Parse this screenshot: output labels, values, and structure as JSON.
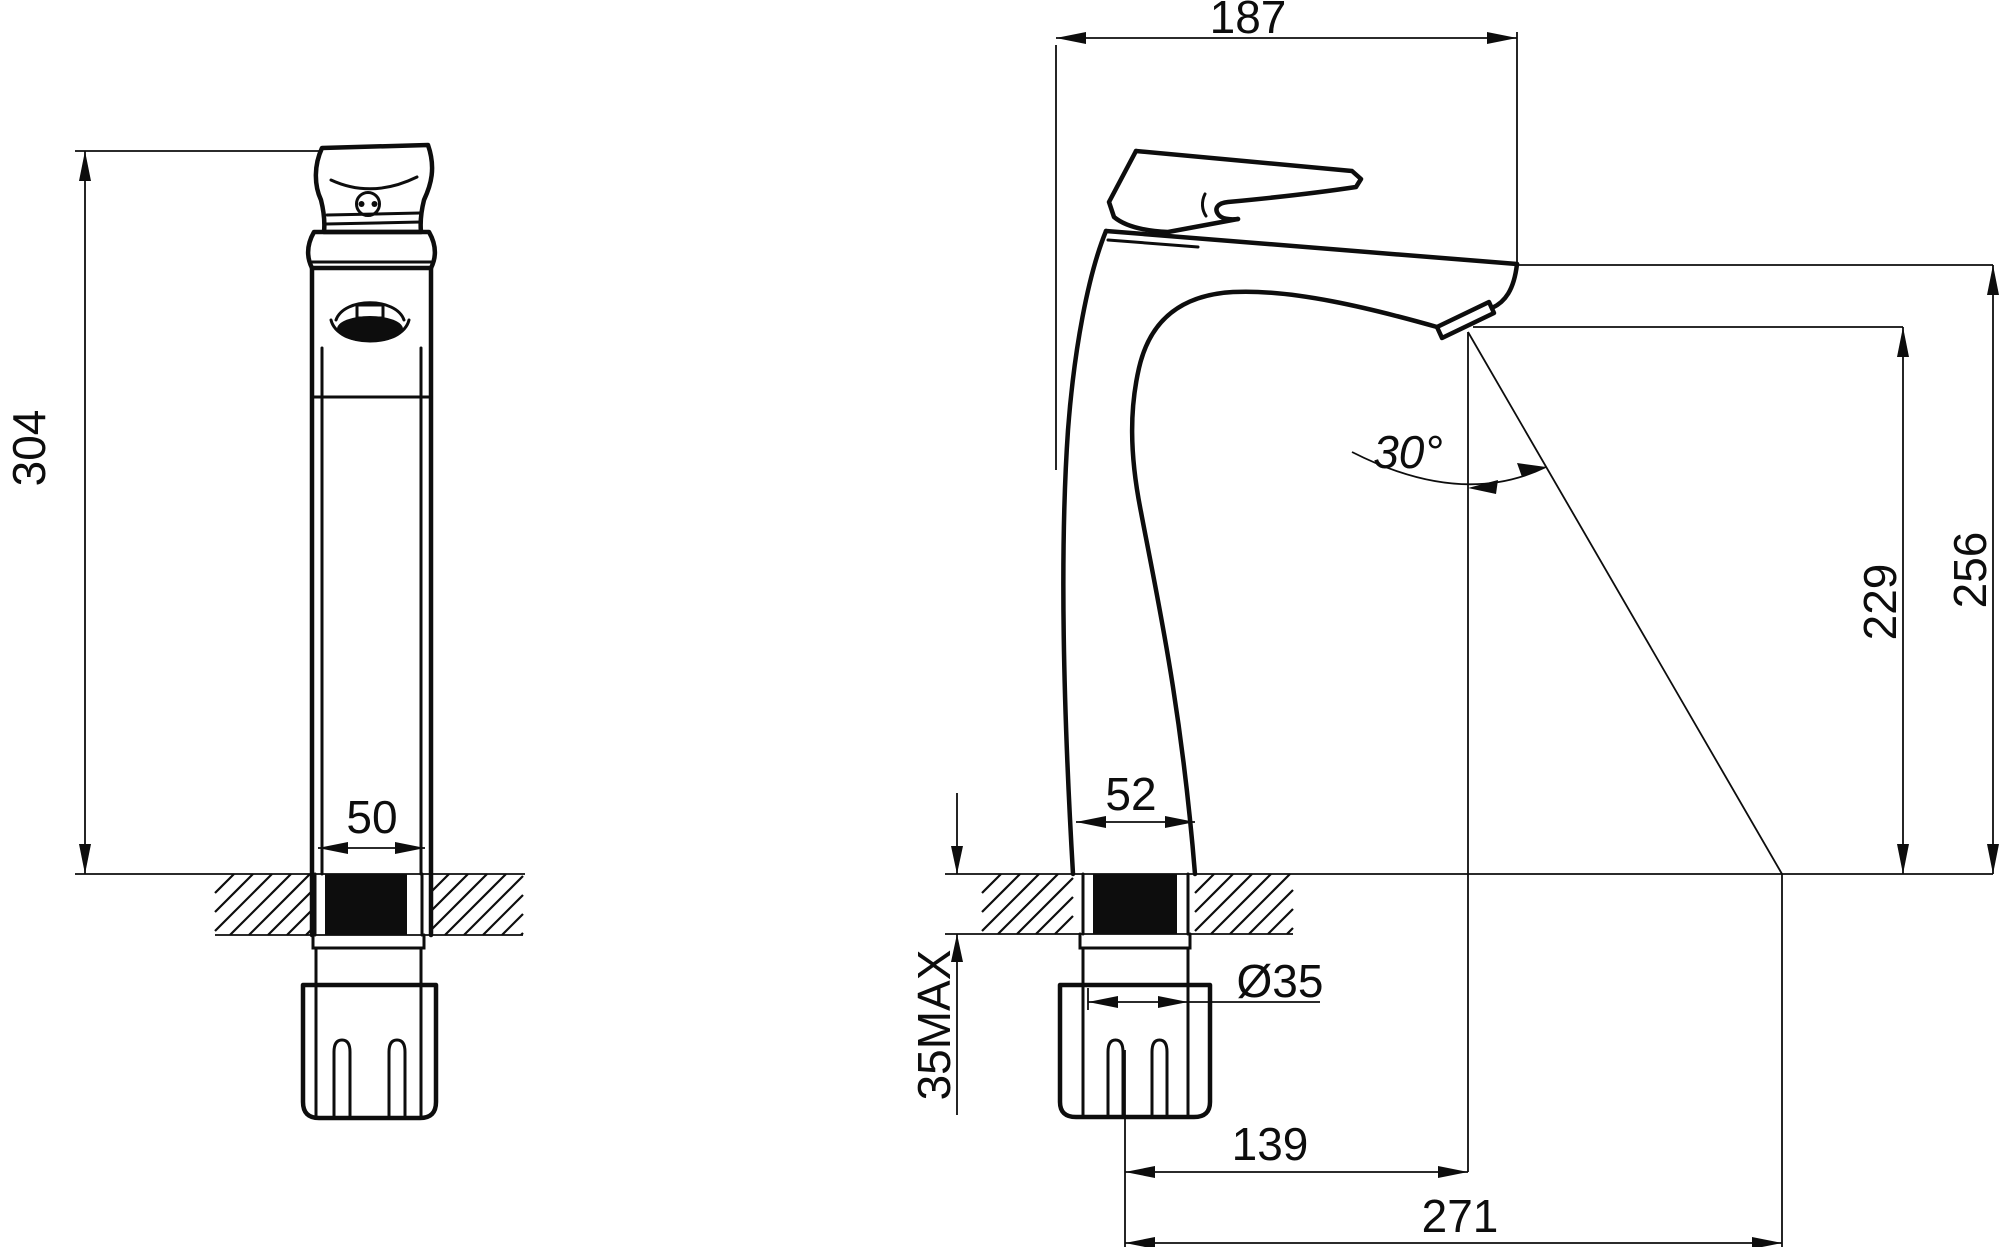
{
  "drawing": {
    "subject": "Two-view dimensioned technical drawing of a tall single-lever basin mixer faucet",
    "units": "mm",
    "colors": {
      "line": "#0d0d0d",
      "background": "#ffffff",
      "seal_fill": "#0d0d0d"
    },
    "front_view": {
      "height": "304",
      "base_width": "50"
    },
    "side_view": {
      "overall_depth": "187",
      "body_base_depth": "52",
      "shank_diameter": "Ø35",
      "max_deck_thickness": "35MAX",
      "spout_reach": "139",
      "stream_reach": "271",
      "spout_angle": "30°",
      "spout_outlet_height": "229",
      "overall_height": "256"
    }
  }
}
